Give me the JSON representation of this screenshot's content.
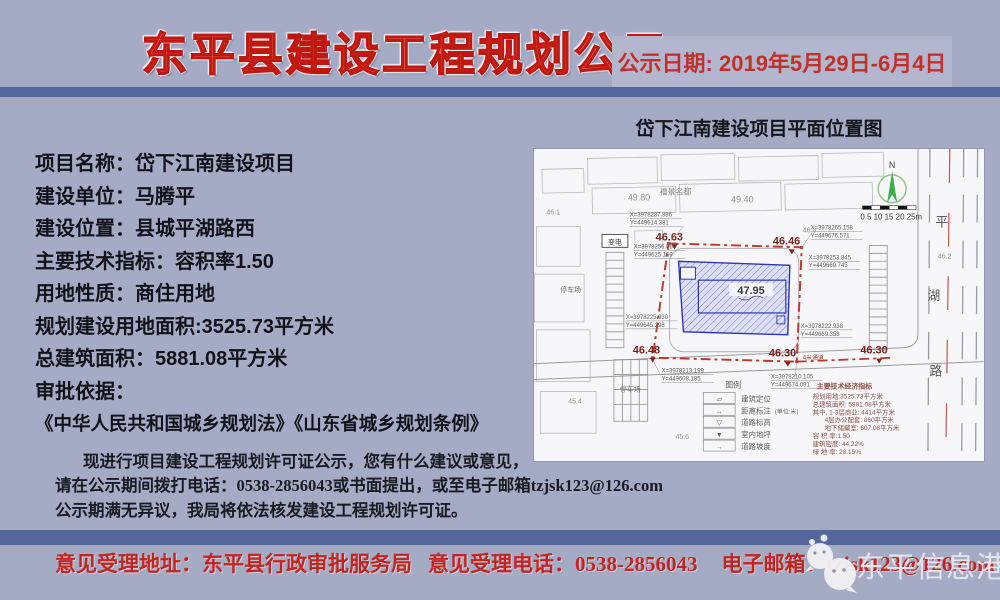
{
  "colors": {
    "background": "#a6abc5",
    "band_blue": "#53679c",
    "title_red": "#c0170e",
    "accent_red": "#c2302a",
    "boundary_red": "#bf3a2e",
    "building_blue": "#2c35b8"
  },
  "header": {
    "title": "东平县建设工程规划公示",
    "date_label": "公示日期: 2019年5月29日-6月4日"
  },
  "info": {
    "lines": [
      {
        "label": "项目名称：",
        "value": "岱下江南建设项目"
      },
      {
        "label": "建设单位：",
        "value": "马腾平"
      },
      {
        "label": "建设位置：",
        "value": "县城平湖路西"
      },
      {
        "label": "主要技术指标：",
        "value": "容积率1.50"
      },
      {
        "label": "用地性质：",
        "value": "商住用地"
      },
      {
        "label": "规划建设用地面积:",
        "value": "3525.73平方米"
      },
      {
        "label": "总建筑面积：",
        "value": "5881.08平方米"
      },
      {
        "label": "审批依据：",
        "value": ""
      }
    ],
    "laws": "《中华人民共和国城乡规划法》《山东省城乡规划条例》",
    "paragraph": [
      "现进行项目建设工程规划许可证公示，您有什么建议或意见，",
      "请在公示期间拨打电话：0538-2856043或书面提出，或至电子邮箱tzjsk123@126.com",
      "公示期满无异议，我局将依法核发建设工程规划许可证。"
    ]
  },
  "map": {
    "title": "岱下江南建设项目平面位置图",
    "compass": "N",
    "scale": "0  5  10 15 20 25m",
    "road_chars": [
      "平",
      "湖",
      "路"
    ],
    "building_elevation": "47.95",
    "corners": [
      "46.63",
      "46.46",
      "46.48",
      "46.30",
      "46.30"
    ],
    "coords": [
      "X=3978287.886",
      "Y=449614.381",
      "X=3978256.060",
      "Y=449625.159",
      "X=3978265.158",
      "Y=449676.571",
      "X=3978253.845",
      "Y=449669.745",
      "X=3978225.930",
      "Y=449645.298",
      "X=3978222.938",
      "Y=449669.358",
      "X=3978213.199",
      "Y=449608.185",
      "X=3978210.105",
      "Y=449674.091"
    ],
    "labels": {
      "estate": "福景名都",
      "transformer": "变电",
      "parking1": "停车场",
      "parking2": "停车场",
      "fire_lane": "4米通道"
    },
    "spot_elevations": [
      "49.80",
      "49.40",
      "46.1",
      "46.0",
      "46.2",
      "45.6",
      "45.4"
    ],
    "legend": {
      "title": "图例",
      "unit": "(单位:米)",
      "items": [
        {
          "symbol": "▱",
          "label": "建筑定位"
        },
        {
          "symbol": "↔",
          "label": "距离标注"
        },
        {
          "symbol": "▽",
          "label": "道路标高"
        },
        {
          "symbol": "▼",
          "label": "室内地坪"
        },
        {
          "symbol": "→",
          "label": "道路坡度"
        }
      ]
    },
    "indicators": {
      "title": "主要技术经济指标",
      "lines": [
        "规划用地:3525.73平方米",
        "总建筑面积: 5881.08平方米",
        "其中, 1-3层商业: 4414平方米",
        "4层办公配套: 860平方米",
        "地下储藏室: 607.08平方米",
        "容 积 率:1.50",
        "建筑密度: 44.22%",
        "绿 地 率: 28.15%"
      ]
    }
  },
  "footer": {
    "address_label": "意见受理地址：",
    "address": "东平县行政审批服务局",
    "phone_label": "意见受理电话：",
    "phone": "0538-2856043",
    "email_label": "电子邮箱：",
    "email": "tzjsk123@126.com",
    "watermark": "东平信息港"
  }
}
